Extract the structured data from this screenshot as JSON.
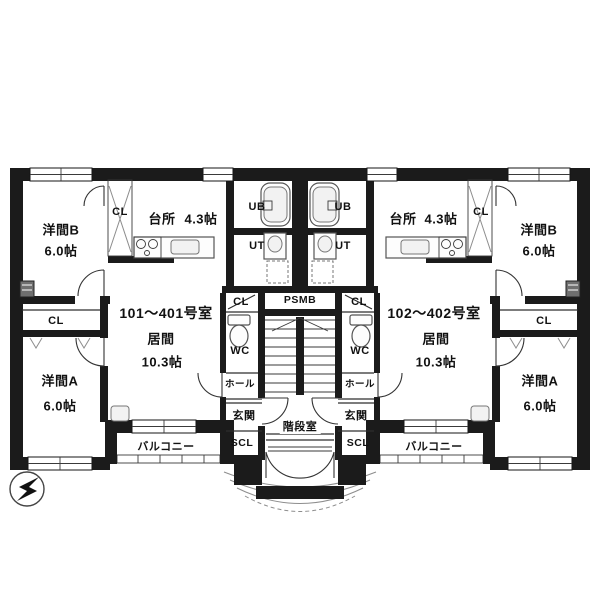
{
  "units": [
    {
      "room_no": "101〜401号室"
    },
    {
      "room_no": "102〜402号室"
    }
  ],
  "labels": {
    "living": "居間",
    "living_area": "10.3帖",
    "kitchen": "台所",
    "kitchen_area": "4.3帖",
    "room_b": "洋間B",
    "room_b_area": "6.0帖",
    "room_a": "洋間A",
    "room_a_area": "6.0帖",
    "cl": "CL",
    "scl": "SCL",
    "ub": "UB",
    "ut": "UT",
    "wc": "WC",
    "hall": "ホール",
    "entrance": "玄関",
    "balcony": "バルコニー",
    "stairwell": "階段室",
    "ps": "PSMB"
  },
  "colors": {
    "wall": "#1b1b1b",
    "background": "#ffffff"
  },
  "compass": {
    "icon": "north-arrow",
    "pointing": "upper-right"
  }
}
